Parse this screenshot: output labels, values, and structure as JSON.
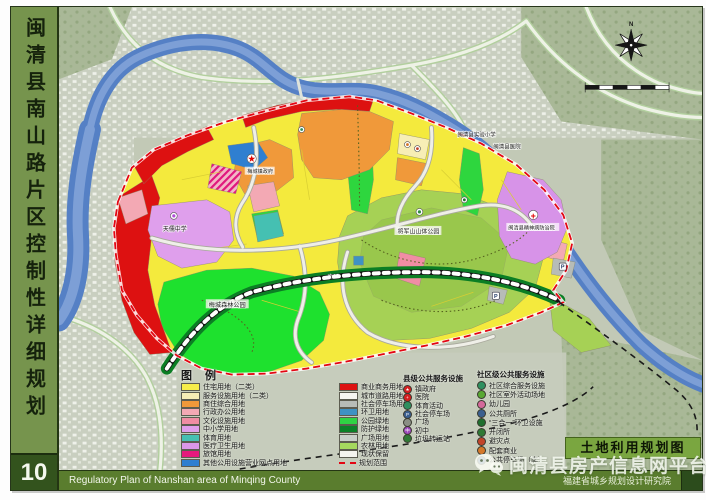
{
  "frame": {
    "sidebar_title": "闽清县南山路片区控制性详细规划",
    "sheet_number": "10",
    "footer_left_en": "Regulatory  Plan of  Nanshan area of  Minqing County",
    "footer_right_cn": "福建省城乡规划设计研究院",
    "map_title_block": "土地利用规划图",
    "watermark_text": "闽清县房产信息网平台"
  },
  "compass": {
    "north_label": "N"
  },
  "legend": {
    "title": "图 例",
    "land_use_columns": {
      "left": [
        {
          "label": "住宅用地（二类）",
          "color": "#f6ed4a",
          "swatch_class": "sw"
        },
        {
          "label": "服务设施用地（二类）",
          "color": "#f7eeb6",
          "swatch_class": "sw"
        },
        {
          "label": "商住综合用地",
          "color": "#f0993a",
          "swatch_class": "sw"
        },
        {
          "label": "行政办公用地",
          "color": "#f3a9b4",
          "swatch_class": "sw"
        },
        {
          "label": "文化设施用地",
          "color": "#f08da4",
          "swatch_class": "sw"
        },
        {
          "label": "中小学用地",
          "color": "#df9fec",
          "swatch_class": "sw"
        },
        {
          "label": "体育用地",
          "color": "#45c0b2",
          "swatch_class": "sw"
        },
        {
          "label": "医疗卫生用地",
          "color": "#da97e8",
          "swatch_class": "sw"
        },
        {
          "label": "旅馆用地",
          "color": "#e6197c",
          "swatch_class": "sw"
        },
        {
          "label": "其他公用设施营业网点用地",
          "color": "#2f7fd0",
          "swatch_class": "sw"
        }
      ],
      "right": [
        {
          "label": "商业商务用地",
          "color": "#dd1111",
          "swatch_class": "sw"
        },
        {
          "label": "城市道路用地",
          "color": "#f6f6f0",
          "swatch_class": "sw"
        },
        {
          "label": "社会停车场用地",
          "color": "#b7bcb7",
          "swatch_class": "sw"
        },
        {
          "label": "环卫用地",
          "color": "#3e92c4",
          "swatch_class": "sw"
        },
        {
          "label": "公园绿地",
          "color": "#2fd344",
          "swatch_class": "sw"
        },
        {
          "label": "防护绿地",
          "color": "#0c8128",
          "swatch_class": "sw"
        },
        {
          "label": "广场用地",
          "color": "#c9cfc9",
          "swatch_class": "sw"
        },
        {
          "label": "农林用地",
          "color": "#a5d95e",
          "swatch_class": "sw"
        },
        {
          "label": "现状保留",
          "color": "#f4f4ee",
          "swatch_class": "sw"
        },
        {
          "label": "规划范围",
          "color": "transparent",
          "swatch_class": "sw sw-dash"
        }
      ]
    },
    "county_facilities": {
      "title": "县级公共服务设施",
      "items": [
        {
          "glyph": "★",
          "color": "#d42020",
          "label": "镇政府"
        },
        {
          "glyph": "+",
          "color": "#d42020",
          "label": "医院"
        },
        {
          "glyph": "",
          "color": "#2f8f5f",
          "label": "体育活动"
        },
        {
          "glyph": "P",
          "color": "#3b5f8f",
          "label": "社会停车场"
        },
        {
          "glyph": "",
          "color": "#8a8f84",
          "label": "广场"
        },
        {
          "glyph": "中",
          "color": "#9a46b8",
          "label": "初中"
        },
        {
          "glyph": "",
          "color": "#2f7a35",
          "label": "垃圾转运站"
        }
      ]
    },
    "community_facilities": {
      "title": "社区级公共服务设施",
      "items": [
        {
          "glyph": "",
          "color": "#2f8f5f",
          "label": "社区综合服务设施"
        },
        {
          "glyph": "",
          "color": "#58a832",
          "label": "社区室外活动场地"
        },
        {
          "glyph": "",
          "color": "#d4699a",
          "label": "幼儿园"
        },
        {
          "glyph": "",
          "color": "#3b5f8f",
          "label": "公共厕所"
        },
        {
          "glyph": "",
          "color": "#1f6f2f",
          "label": "“三合一”环卫设施"
        },
        {
          "glyph": "",
          "color": "#2f7a35",
          "label": "开闭所"
        },
        {
          "glyph": "",
          "color": "#c2442a",
          "label": "避灾点"
        },
        {
          "glyph": "",
          "color": "#d4782a",
          "label": "配套商业"
        },
        {
          "glyph": "P",
          "color": "#3b5f8f",
          "label": "公共停车场（库）"
        }
      ]
    }
  },
  "map_labels": {
    "town_government": "梅城镇政府",
    "middle_school": "天儒中学",
    "forest_park": "梅城森林公园",
    "hill_park": "将军山山体公园",
    "psychiatric_hospital": "闽清县精神病防治院",
    "experimental_primary_school": "闽清县实验小学",
    "county_hospital": "闽清县医院",
    "road_marker": "南35"
  },
  "map_icons": {
    "government_star": "★",
    "hospital_cross": "+",
    "parking_p": "P"
  }
}
